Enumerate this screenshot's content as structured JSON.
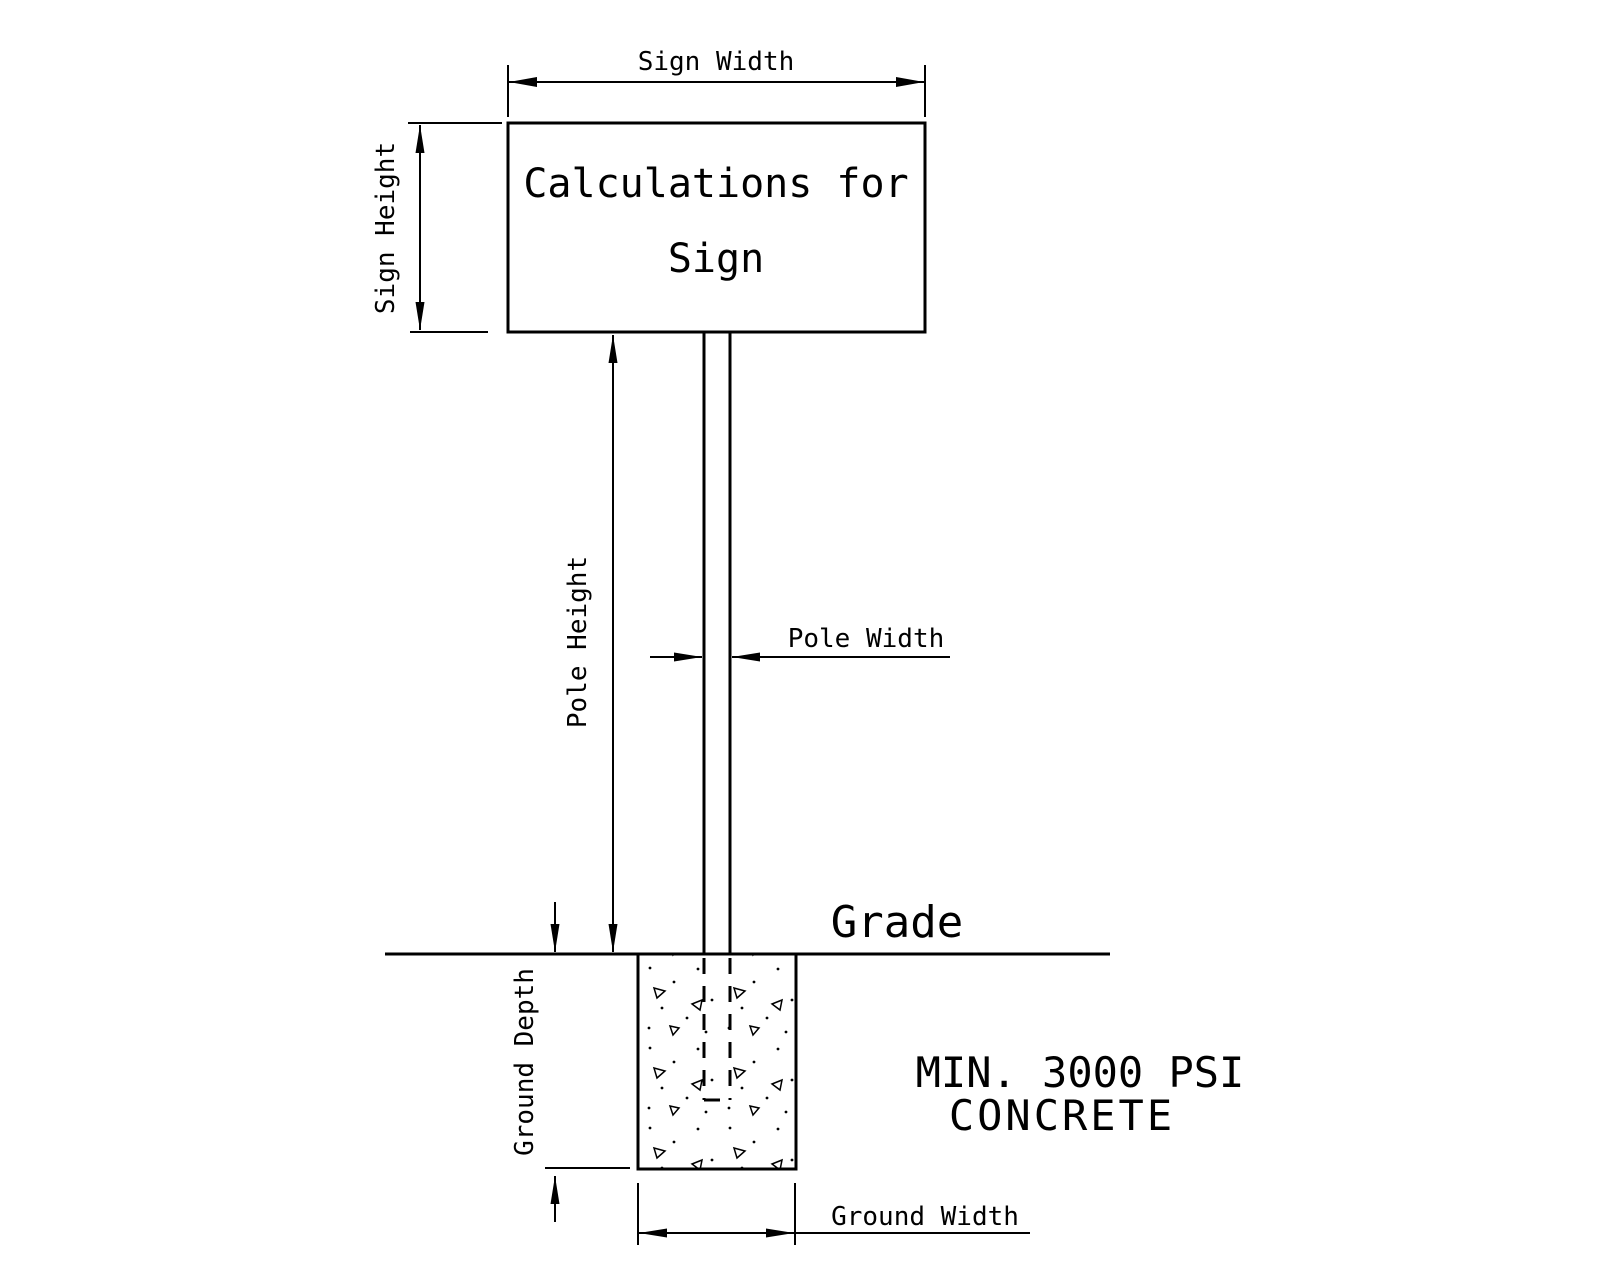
{
  "diagram": {
    "title_hint": "Sign footing calculation diagram",
    "sign": {
      "line1": "Calculations for",
      "line2": "Sign"
    },
    "dimensions": {
      "sign_width": "Sign Width",
      "sign_height": "Sign Height",
      "pole_height": "Pole Height",
      "pole_width": "Pole Width",
      "ground_depth": "Ground Depth",
      "ground_width": "Ground Width"
    },
    "grade_label": "Grade",
    "concrete_note": {
      "line1": "MIN. 3000 PSI",
      "line2": "CONCRETE"
    },
    "colors": {
      "line": "#000000",
      "background": "#ffffff"
    }
  }
}
